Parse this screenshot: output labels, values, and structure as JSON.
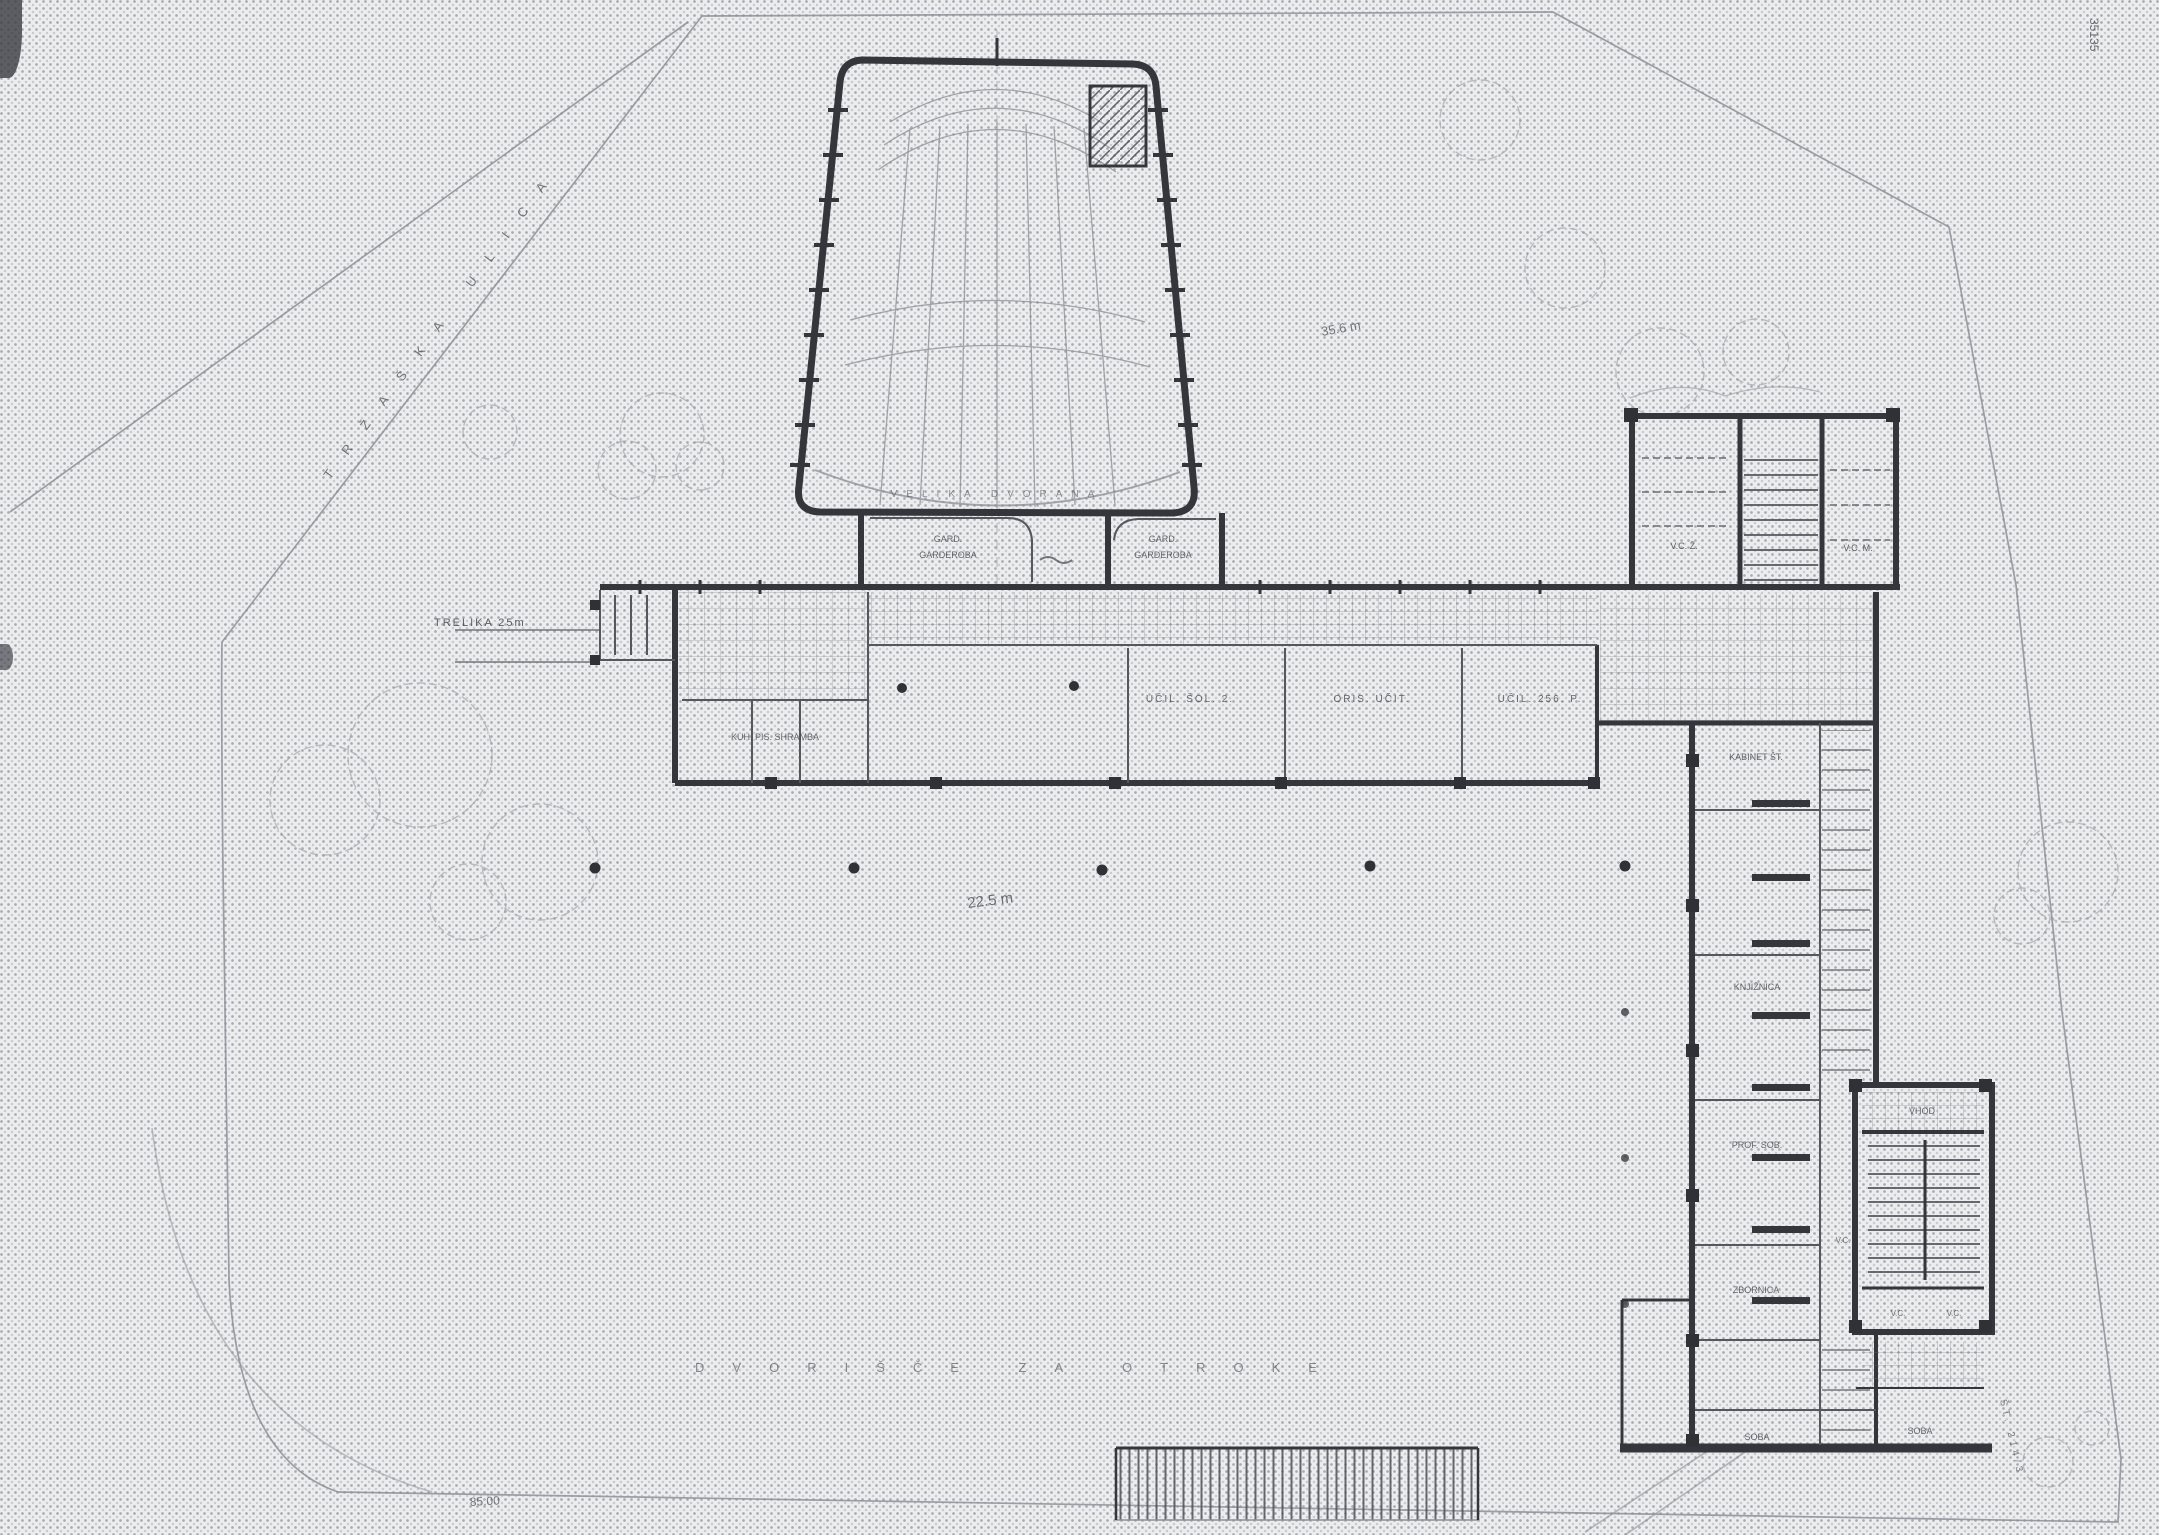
{
  "meta": {
    "plate_number": "35135"
  },
  "colors": {
    "paper": "#ecedef",
    "halftone_dot": "#8f909b",
    "ink_dark": "#35363c",
    "ink_medium": "#55565e",
    "ink_faint": "#8e8f99"
  },
  "site": {
    "street_label": "TRŽAŠKA ULICA",
    "parcel_note": "ŠT. 214/3"
  },
  "entrance": {
    "gate_label": "TRELIKA  25m"
  },
  "auditorium": {
    "hall_label": "VELIKA DVORANA"
  },
  "cloakrooms": {
    "left_line1": "GARD.",
    "left_line2": "GARDEROBA",
    "right_line1": "GARD.",
    "right_line2": "GARDEROBA"
  },
  "west_wing": {
    "service_rooms": "KUH.  PIS.  SHRAMBA",
    "classroom_1": "UČIL. ŠOL. 2.",
    "classroom_2": "ORIS. UČIT.",
    "classroom_3": "UČIL. 256. P."
  },
  "wc_block": {
    "left": "V.C. Ž.",
    "right": "V.C. M."
  },
  "south_wing": {
    "room_1": "KABINET ŠT.",
    "room_2": "KNJIŽNICA",
    "room_3": "PROF. SOB.",
    "room_4": "ZBORNICA",
    "room_5": "SOBA",
    "room_6": "SOBA",
    "wc_note": "V.C."
  },
  "southeast_stair": {
    "hall": "VHOD",
    "wc_1": "V.C.",
    "wc_2": "V.C."
  },
  "courtyard": {
    "caption": "DVORIŠČE ZA OTROKE",
    "width_dim": "22.5 m"
  },
  "dimensions": {
    "north_dim": "35.6 m",
    "west_dim": "85.00"
  }
}
